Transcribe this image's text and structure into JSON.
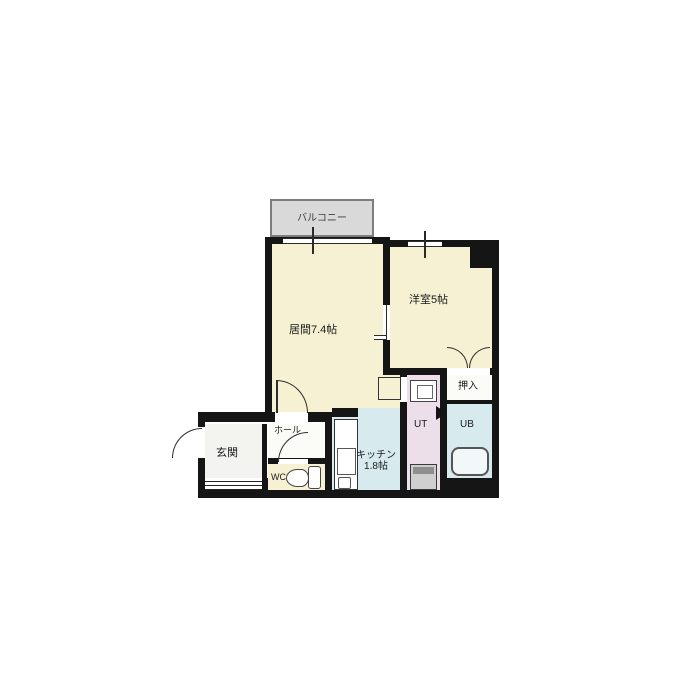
{
  "plan": {
    "type": "apartment-floor-plan",
    "labels": {
      "balcony": "バルコニー",
      "living": "居間7.4帖",
      "western_room": "洋室5帖",
      "closet": "押入",
      "unit_bath": "UB",
      "utility": "UT",
      "kitchen_line1": "キッチン",
      "kitchen_line2": "1.8帖",
      "hall": "ホール",
      "wc": "WC",
      "entrance": "玄関"
    },
    "colors": {
      "room_cream": "#f6f1d3",
      "room_blue": "#d7eaee",
      "room_pink": "#eddfe9",
      "balcony_grey": "#d9d9d9",
      "wall": "#151515"
    }
  }
}
